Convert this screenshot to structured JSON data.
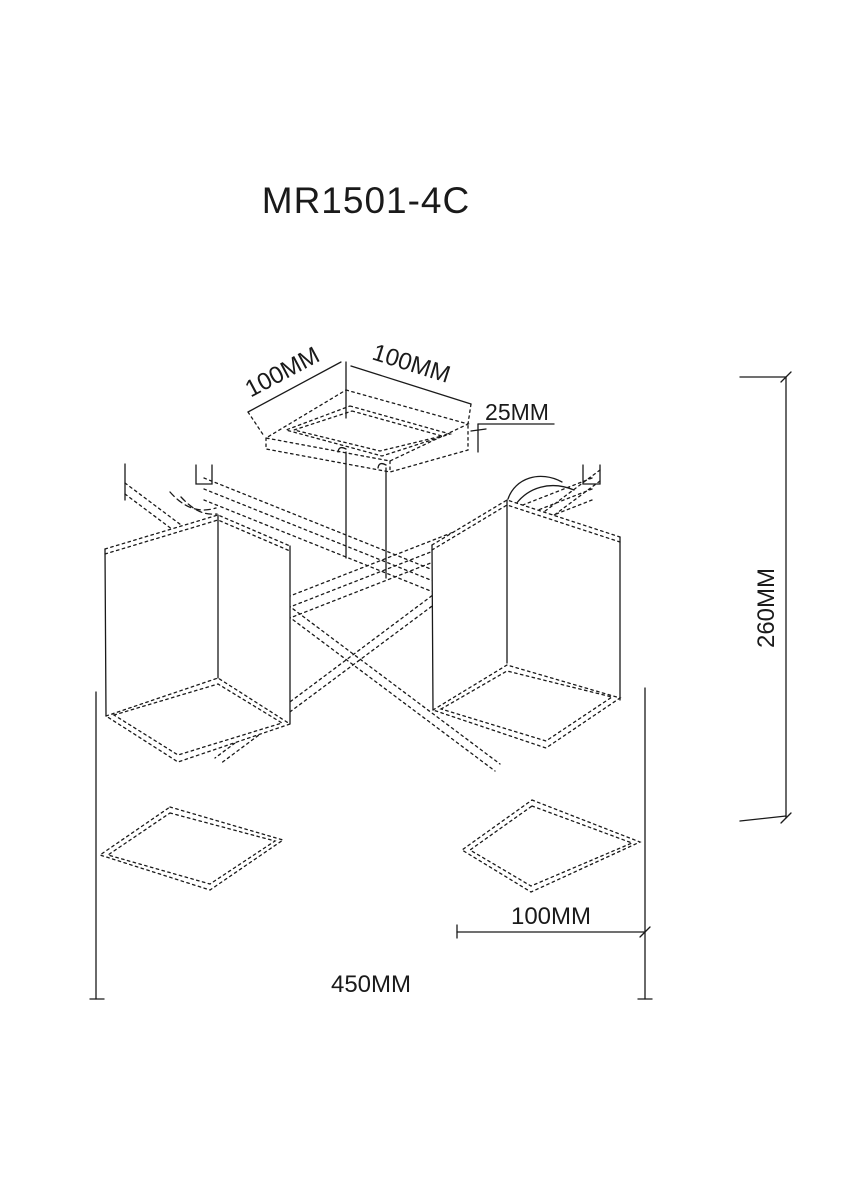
{
  "page": {
    "background": "#ffffff",
    "line_color": "#1a1a1a"
  },
  "title": {
    "text": "MR1501-4C"
  },
  "drawing": {
    "type": "technical-line-drawing",
    "subject": "4-light ceiling chandelier, isometric view with dimension lines",
    "dimensions": [
      {
        "id": "canopy-side-left",
        "label": "100MM",
        "orientation": "diagonal-left"
      },
      {
        "id": "canopy-side-right",
        "label": "100MM",
        "orientation": "diagonal-right"
      },
      {
        "id": "canopy-thickness",
        "label": "25MM",
        "orientation": "horizontal"
      },
      {
        "id": "fixture-height",
        "label": "260MM",
        "orientation": "vertical"
      },
      {
        "id": "shade-width",
        "label": "100MM",
        "orientation": "horizontal"
      },
      {
        "id": "fixture-width",
        "label": "450MM",
        "orientation": "horizontal"
      }
    ]
  }
}
